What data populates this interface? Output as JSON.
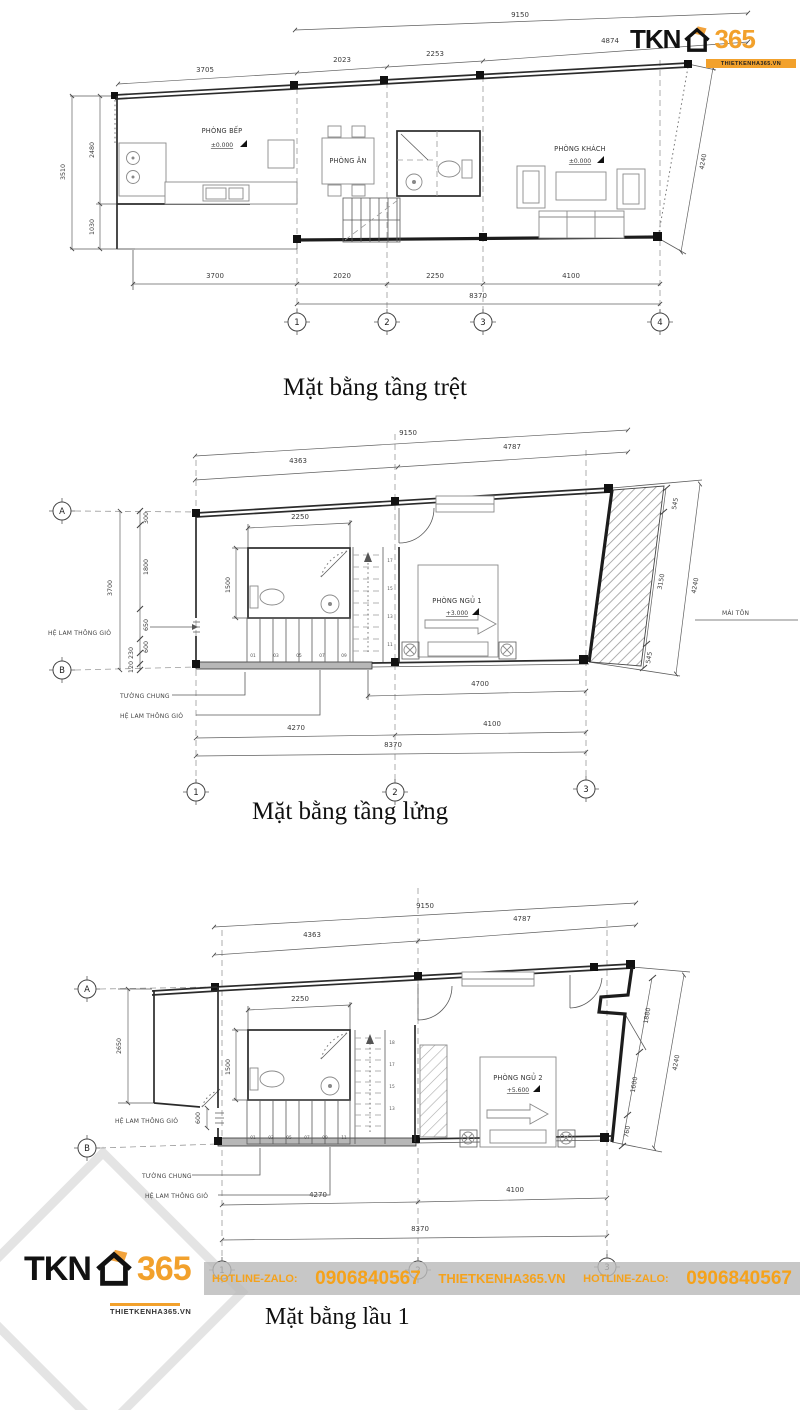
{
  "captions": {
    "plan1": "Mặt bằng tầng trệt",
    "plan2": "Mặt bằng tầng lửng",
    "plan3": "Mặt bằng lầu 1"
  },
  "brand": {
    "tkn": "TKN",
    "n365": "365",
    "site": "THIETKENHA365.VN"
  },
  "hotline": {
    "label1": "HOTLINE-ZALO:",
    "phone1": "0906840567",
    "site": "THIETKENHA365.VN",
    "label2": "HOTLINE-ZALO:",
    "phone2": "0906840567"
  },
  "plan1": {
    "dim_top_total": "9150",
    "dim_top": [
      "3705",
      "2023",
      "2253",
      "4874"
    ],
    "dim_left_total": "3510",
    "dim_left": [
      "2480",
      "1030"
    ],
    "dim_right": "4240",
    "dim_bottom": [
      "3700",
      "2020",
      "2250",
      "4100"
    ],
    "dim_bottom_total": "8370",
    "grids": [
      "1",
      "2",
      "3",
      "4"
    ],
    "kitchen": "PHÒNG BẾP",
    "kitchen_level": "±0.000",
    "dining": "PHÒNG ĂN",
    "living": "PHÒNG KHÁCH",
    "living_level": "±0.000"
  },
  "plan2": {
    "dim_top_total": "9150",
    "dim_top": [
      "4363",
      "4787"
    ],
    "dim_wc_w": "2250",
    "dim_wc_h": "1500",
    "dim_left_total": "3700",
    "dim_left": [
      "300",
      "1800",
      "650",
      "600",
      "230",
      "120"
    ],
    "dim_right": [
      "545",
      "3150",
      "545"
    ],
    "dim_right_total": "4240",
    "dim_inner_bottom": "4700",
    "dim_bottom": [
      "4270",
      "4100"
    ],
    "dim_bottom_total": "8370",
    "label_louver": "HỆ LAM THÔNG GIÓ",
    "label_shared_wall": "TƯỜNG CHUNG",
    "label_louver2": "HỆ LAM THÔNG GIÓ",
    "label_roof": "MÁI TÔN",
    "bedroom": "PHÒNG NGỦ 1",
    "bedroom_level": "+3.000",
    "grid_rows": [
      "A",
      "B"
    ],
    "grid_cols": [
      "1",
      "2",
      "3"
    ],
    "stairs_down": [
      "01",
      "03",
      "05",
      "07",
      "09"
    ],
    "stairs_up": [
      "17",
      "15",
      "13",
      "11"
    ]
  },
  "plan3": {
    "dim_top_total": "9150",
    "dim_top": [
      "4363",
      "4787"
    ],
    "dim_wc_w": "2250",
    "dim_wc_h": "1500",
    "dim_left": "2650",
    "dim_louver": "600",
    "dim_right": [
      "1880",
      "1600",
      "760"
    ],
    "dim_right_total": "4240",
    "dim_bottom": [
      "4270",
      "4100"
    ],
    "dim_bottom_total": "8370",
    "label_louver": "HỆ LAM THÔNG GIÓ",
    "label_shared_wall": "TƯỜNG CHUNG",
    "label_louver2": "HỆ LAM THÔNG GIÓ",
    "bedroom": "PHÒNG NGỦ 2",
    "bedroom_level": "+5.600",
    "grid_rows": [
      "A",
      "B"
    ],
    "grid_cols": [
      "1",
      "2",
      "3"
    ],
    "stairs_down": [
      "01",
      "03",
      "05",
      "07",
      "09",
      "11"
    ],
    "stairs_up": [
      "18",
      "17",
      "15",
      "13"
    ]
  }
}
